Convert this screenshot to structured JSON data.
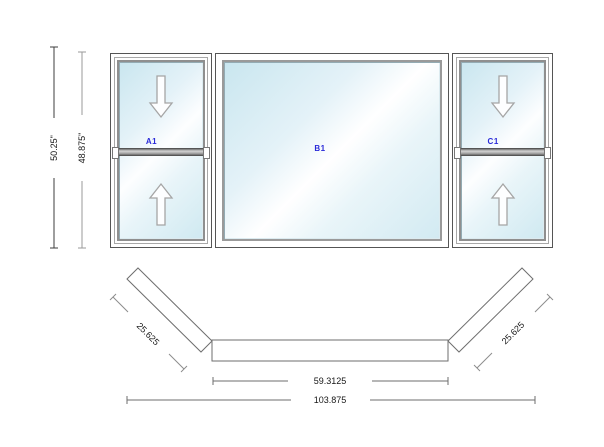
{
  "drawing": {
    "type": "window-configuration-drawing",
    "colors": {
      "frame_line": "#555555",
      "plan_line": "#6e6e6e",
      "dim_line_dark": "#3c3c3c",
      "dim_line_light": "#9a9a9a",
      "glass_blue": "#c9e6ef",
      "unit_label_blue": "#2a2ad8"
    },
    "panels": [
      {
        "label": "A1",
        "type": "double-hung",
        "arrows": [
          "down-arrow",
          "up-arrow"
        ]
      },
      {
        "label": "B1",
        "type": "picture"
      },
      {
        "label": "C1",
        "type": "double-hung",
        "arrows": [
          "down-arrow",
          "up-arrow"
        ]
      }
    ],
    "dimensions": {
      "height_overall": "50.25\"",
      "height_frame": "48.875\"",
      "flanker_left": "25.625",
      "flanker_right": "25.625",
      "center_width": "59.3125",
      "total_width": "103.875"
    }
  }
}
